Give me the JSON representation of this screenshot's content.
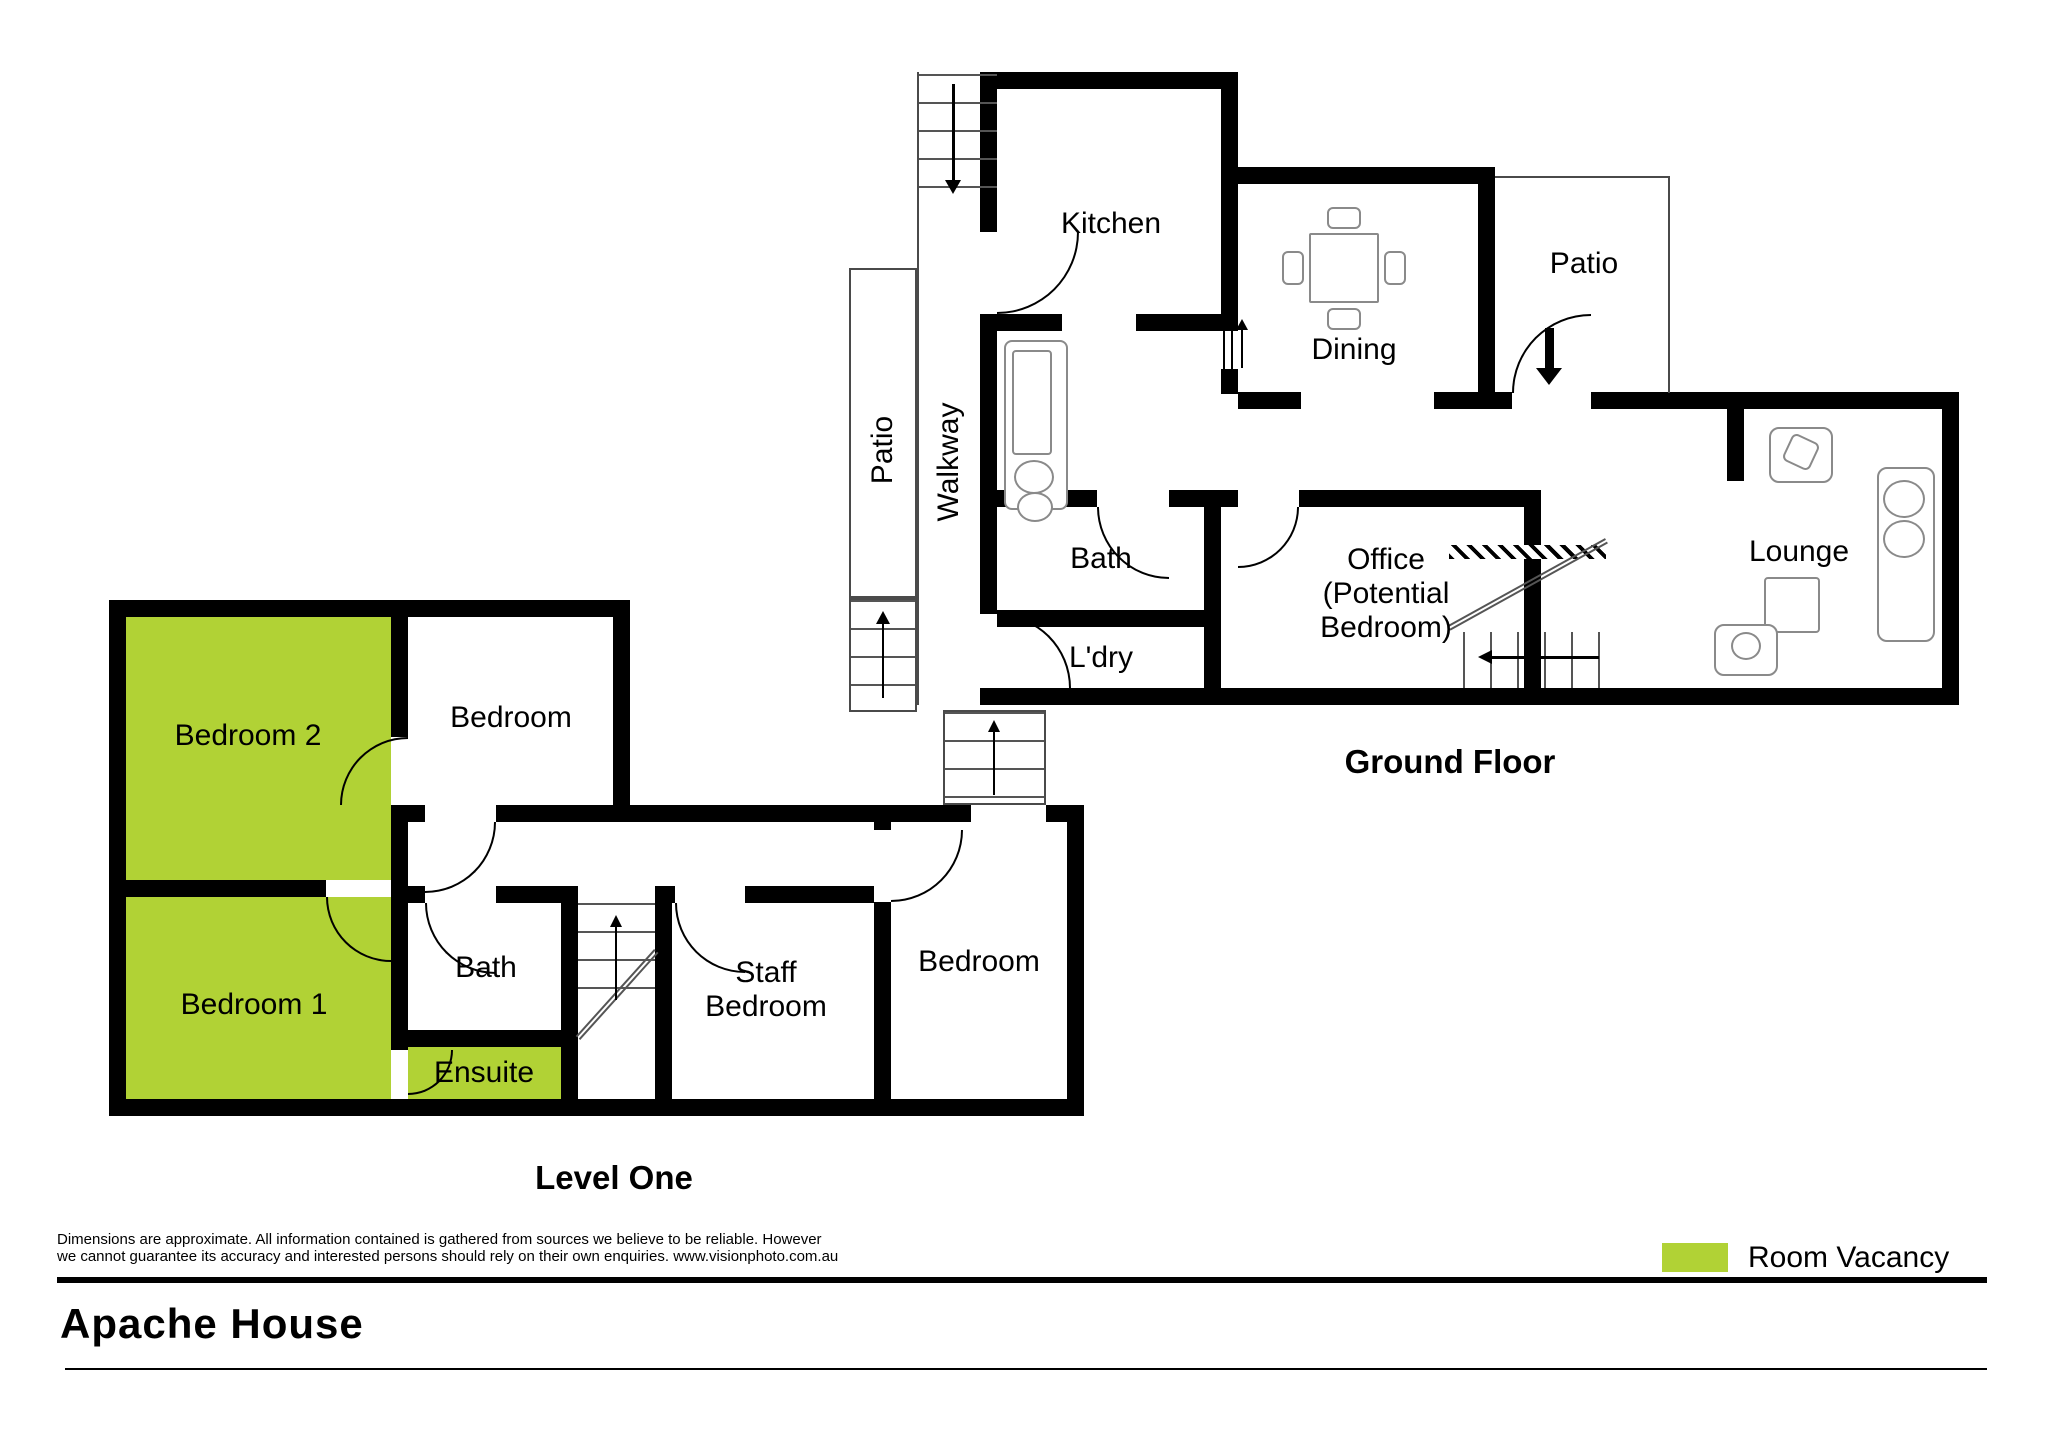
{
  "title": "Apache House",
  "legend": {
    "label": "Room Vacancy",
    "vacancy_color": "#b1d235"
  },
  "disclaimer": {
    "line1": "Dimensions are approximate. All information contained is gathered from sources we believe to be reliable. However",
    "line2": "we cannot guarantee its accuracy and interested persons should rely on their own enquiries. www.visionphoto.com.au"
  },
  "ground_floor": {
    "title": "Ground Floor",
    "rooms": [
      {
        "label": "Kitchen"
      },
      {
        "label": "Dining"
      },
      {
        "label": "Patio"
      },
      {
        "label": "Patio"
      },
      {
        "label": "Walkway"
      },
      {
        "label": "Bath"
      },
      {
        "label": "L'dry"
      },
      {
        "label": "Office\n(Potential\nBedroom)"
      },
      {
        "label": "Lounge"
      }
    ]
  },
  "level_one": {
    "title": "Level One",
    "rooms": [
      {
        "label": "Bedroom 2"
      },
      {
        "label": "Bedroom"
      },
      {
        "label": "Bedroom 1"
      },
      {
        "label": "Bath"
      },
      {
        "label": "Ensuite"
      },
      {
        "label": "Staff\nBedroom"
      },
      {
        "label": "Bedroom"
      }
    ]
  }
}
